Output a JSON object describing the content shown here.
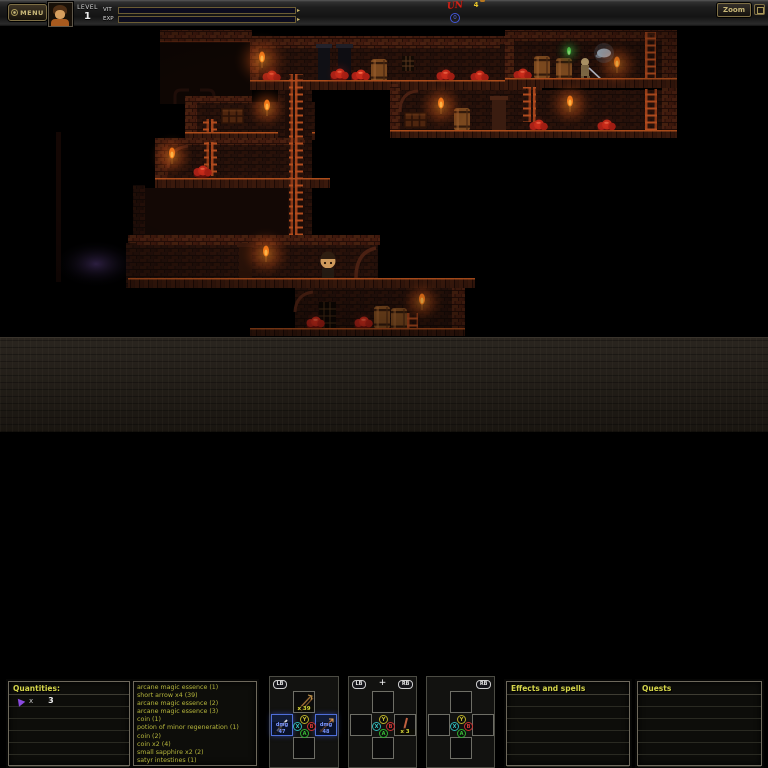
{
  "topbar": {
    "menu_label": "MENU",
    "level_label": "LEVEL",
    "level_value": "1",
    "vit_label": "VIT",
    "exp_label": "EXP",
    "vit_fill_style": "width:27%",
    "exp_fill_style": "width:34%",
    "unread_mark": "UN",
    "scroll_count": "0",
    "coin_count": "4",
    "zoom_label": "Zoom"
  },
  "panels": {
    "quantities": {
      "title": "Quantities:",
      "row": {
        "icon": "purple-arrow-icon",
        "label": "x",
        "value": "3"
      }
    },
    "inventory": {
      "items": [
        "arcane magic essence (1)",
        "short arrow x4 (39)",
        "arcane magic essence (2)",
        "arcane magic essence (3)",
        "coin (1)",
        "potion of minor regeneration (1)",
        "coin (2)",
        "coin x2 (4)",
        "small sapphire x2 (2)",
        "satyr intestines (1)"
      ]
    },
    "effects": {
      "title": "Effects and spells"
    },
    "quests": {
      "title": "Quests"
    }
  },
  "slots": {
    "left": {
      "badge": "LB",
      "top_count": "x 39",
      "left_value": "dmg 47",
      "right_value": "dmg 48"
    },
    "middle": {
      "badge_left": "LB",
      "badge_right": "RB",
      "plus": "+",
      "right_count": "x 3"
    },
    "right": {
      "badge": "RB"
    },
    "buttons": {
      "top": "Y",
      "left": "X",
      "right": "B",
      "bottom": "A"
    }
  },
  "colors": {
    "vit_bar": "#d81c10",
    "exp_bar": "#e07812",
    "panel_text_yellow": "#b6b63c",
    "header_yellow": "#d6d64a",
    "selection_blue": "#4f6fd8",
    "quantity_purple": "#8a4ae0",
    "torch_orange": "#ef7514",
    "mushroom_red": "#c92a19"
  }
}
